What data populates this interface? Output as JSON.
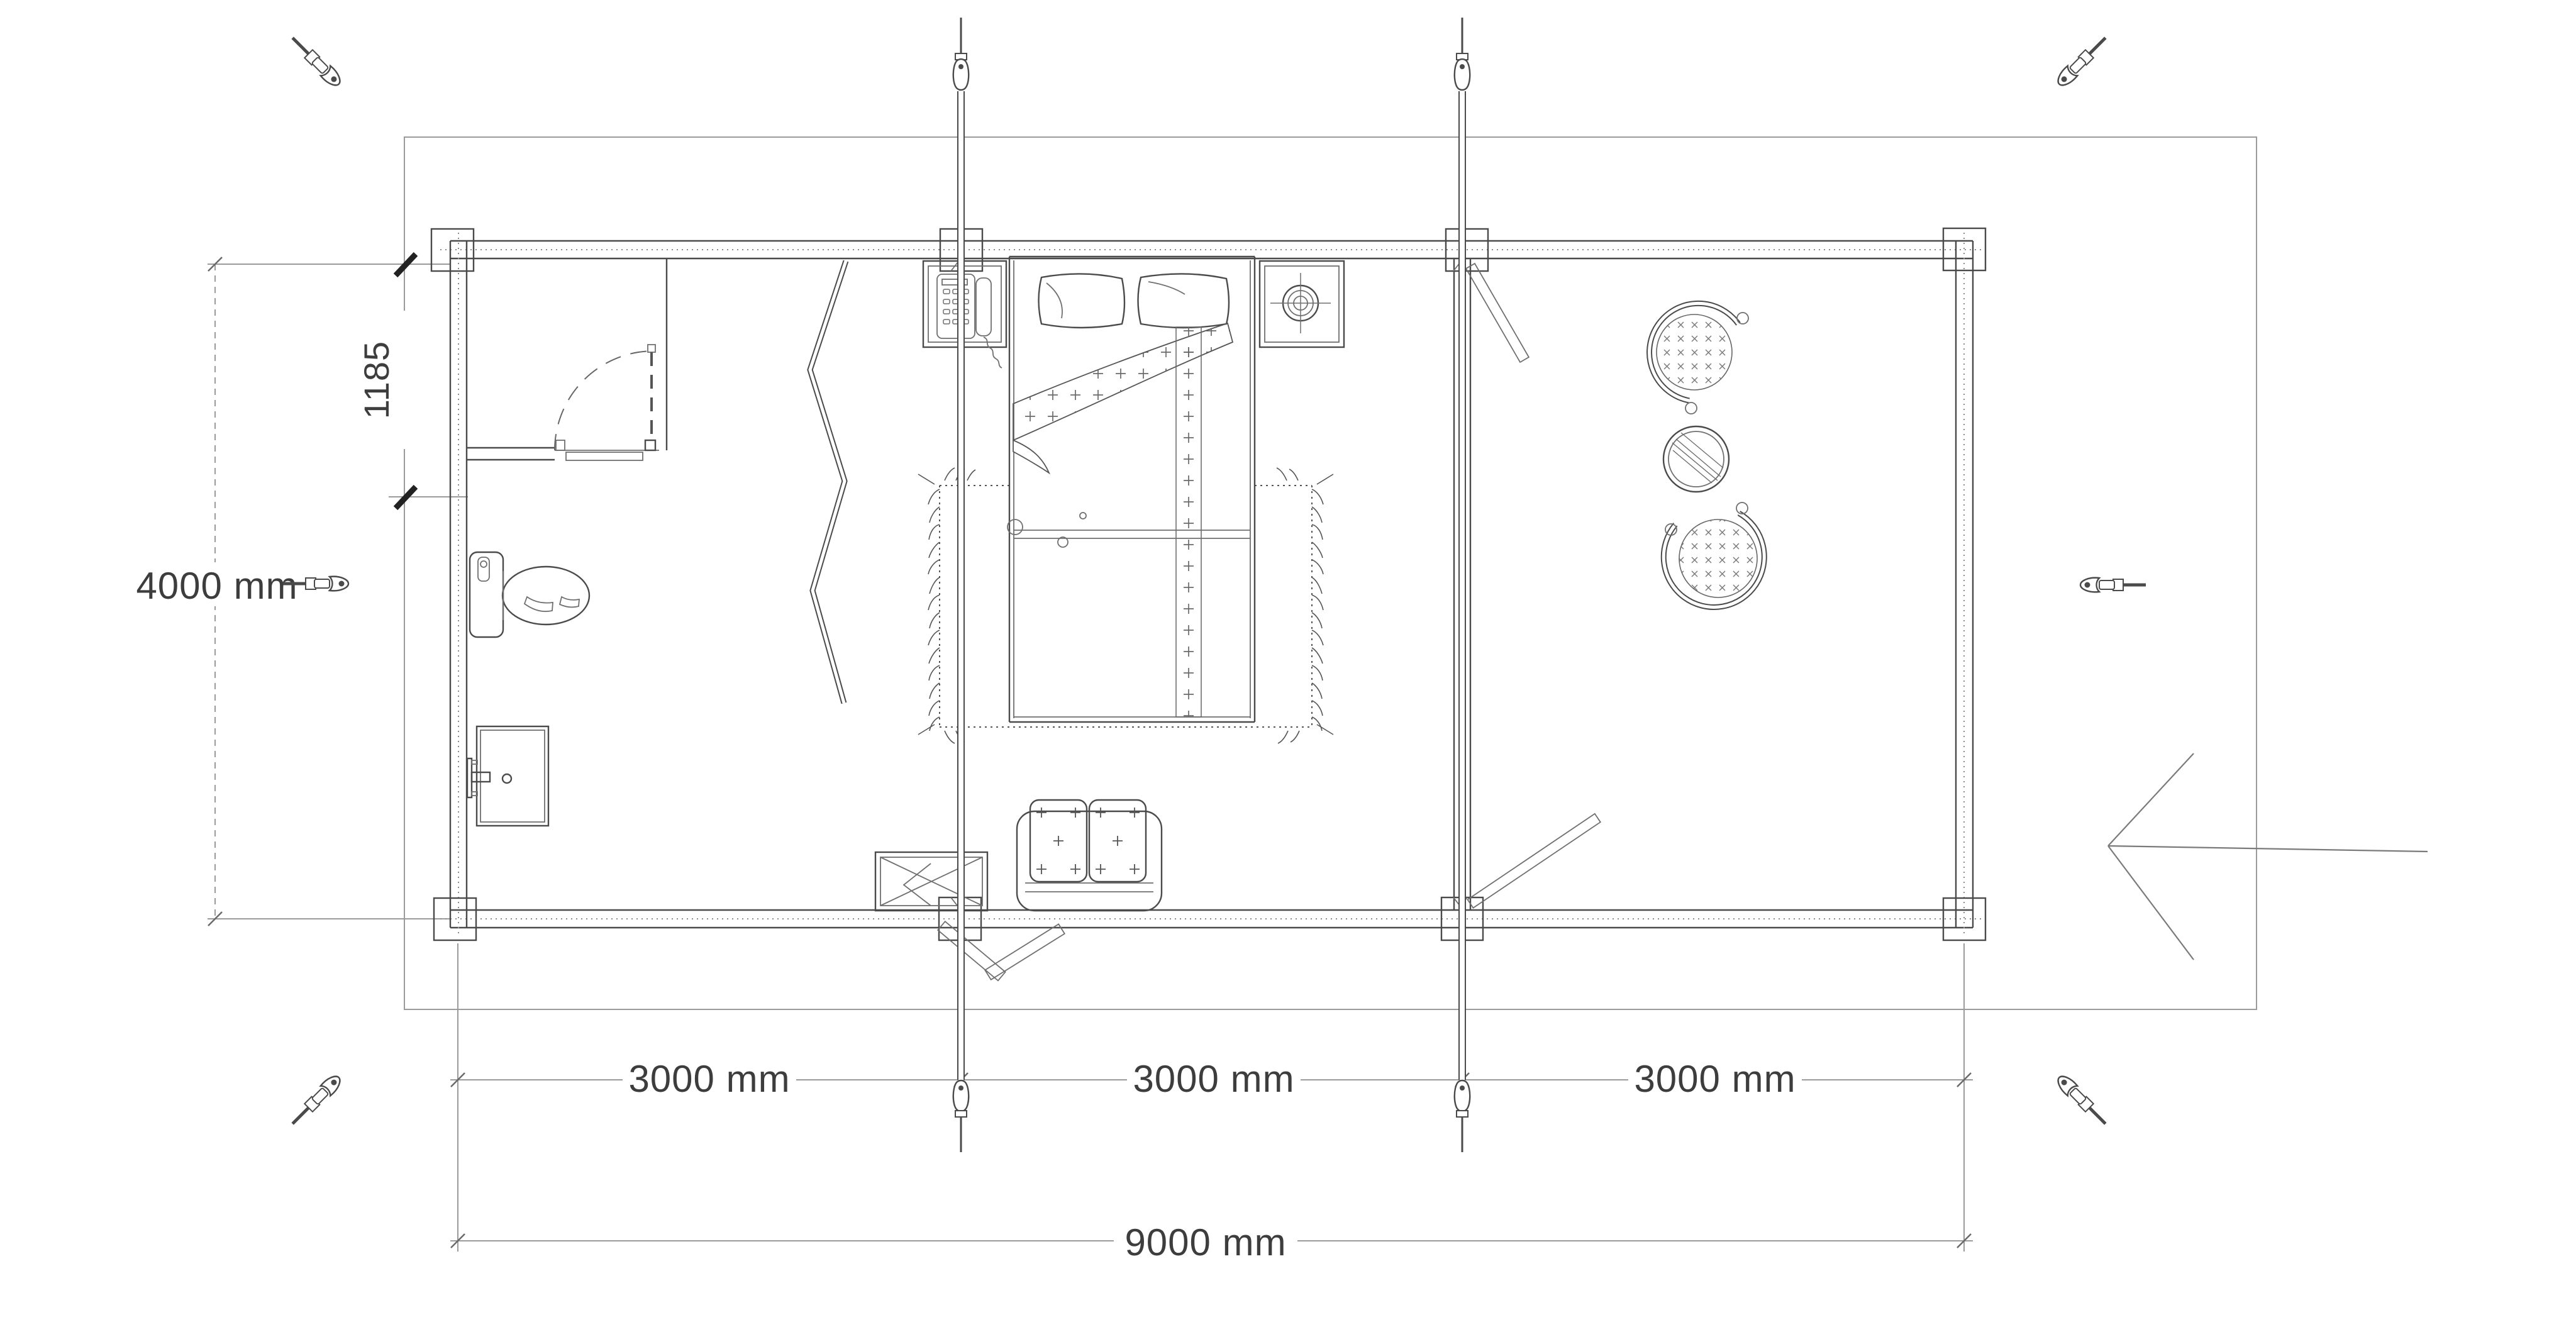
{
  "drawing": {
    "type": "floor-plan",
    "unit": "mm",
    "overall_width": "9000 mm",
    "overall_depth": "4000 mm",
    "bay_widths": [
      "3000 mm",
      "3000 mm",
      "3000 mm"
    ],
    "wc_partition_offset": "1185"
  },
  "labels": {
    "depth_total": "4000 mm",
    "wc_offset": "1185",
    "bay1": "3000 mm",
    "bay2": "3000 mm",
    "bay3": "3000 mm",
    "width_total": "9000 mm"
  },
  "icons": [
    "turnbuckle-screw-icon",
    "storm-brace-rod-icon",
    "entrance-arrow-icon"
  ],
  "furniture": [
    "toilet",
    "bathroom-sink",
    "interior-door",
    "folding-screen",
    "double-bed",
    "pillows",
    "nightstand-left",
    "telephone",
    "nightstand-right",
    "table-lamp",
    "rug",
    "storage-cabinet",
    "sofa",
    "entrance-door-leaves",
    "partition-door-leaves",
    "armchair-top",
    "armchair-bottom",
    "coffee-table"
  ],
  "theme": {
    "line-dark": "#4a4a4a",
    "line-mid": "#6f6f6f",
    "line-light": "#9b9b9b",
    "text-color": "#3d3d3d",
    "bg": "#ffffff"
  }
}
